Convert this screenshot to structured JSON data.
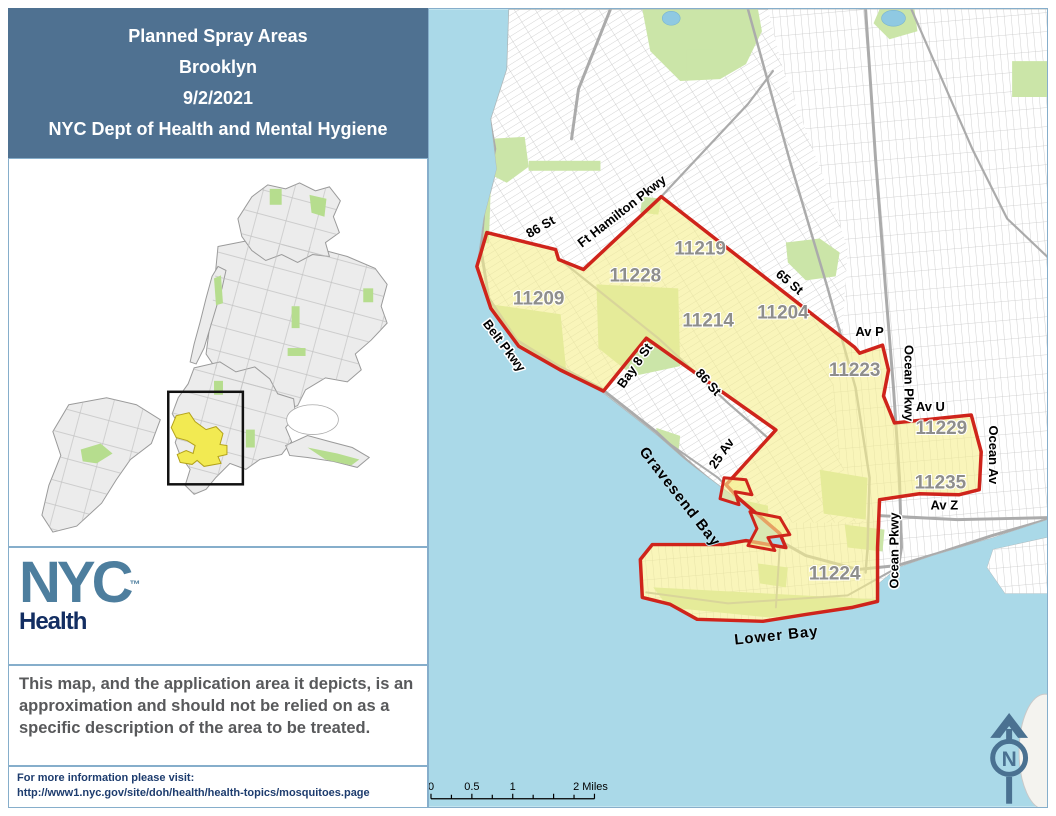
{
  "title_block": {
    "lines": [
      "Planned Spray Areas",
      "Brooklyn",
      "9/2/2021",
      "NYC Dept of Health and Mental Hygiene"
    ]
  },
  "logo": {
    "nyc": "NYC",
    "tm": "™",
    "sub": "Health"
  },
  "disclaimer": "This map, and the application area it depicts, is an approximation and should not be relied on as a specific description of the area to be treated.",
  "footer": {
    "line1": "For more information please visit:",
    "line2": "http://www1.nyc.gov/site/doh/health/health-topics/mosquitoes.page"
  },
  "map": {
    "zip_labels": [
      {
        "text": "11219",
        "x": 272,
        "y": 246
      },
      {
        "text": "11228",
        "x": 207,
        "y": 273
      },
      {
        "text": "11209",
        "x": 110,
        "y": 296
      },
      {
        "text": "11214",
        "x": 280,
        "y": 318
      },
      {
        "text": "11204",
        "x": 355,
        "y": 310
      },
      {
        "text": "11223",
        "x": 427,
        "y": 368
      },
      {
        "text": "11229",
        "x": 514,
        "y": 426
      },
      {
        "text": "11235",
        "x": 513,
        "y": 481
      },
      {
        "text": "11224",
        "x": 407,
        "y": 572
      }
    ],
    "street_labels": [
      {
        "text": "86 St",
        "x": 114,
        "y": 222,
        "rot": -30
      },
      {
        "text": "Ft Hamilton Pkwy",
        "x": 196,
        "y": 206,
        "rot": -38
      },
      {
        "text": "65 St",
        "x": 359,
        "y": 277,
        "rot": 40
      },
      {
        "text": "Belt Pkwy",
        "x": 72,
        "y": 340,
        "rot": 53
      },
      {
        "text": "Bay 8 St",
        "x": 210,
        "y": 360,
        "rot": -55
      },
      {
        "text": "86 St",
        "x": 277,
        "y": 377,
        "rot": 48
      },
      {
        "text": "25 Av",
        "x": 297,
        "y": 448,
        "rot": -55
      },
      {
        "text": "Av P",
        "x": 442,
        "y": 328,
        "rot": 0
      },
      {
        "text": "Ocean Pkwy",
        "x": 477,
        "y": 375,
        "rot": 90
      },
      {
        "text": "Av U",
        "x": 503,
        "y": 403,
        "rot": 0
      },
      {
        "text": "Ocean Av",
        "x": 562,
        "y": 447,
        "rot": 90
      },
      {
        "text": "Av Z",
        "x": 517,
        "y": 502,
        "rot": 0
      },
      {
        "text": "Ocean Pkwy",
        "x": 471,
        "y": 543,
        "rot": -90
      }
    ],
    "water_labels": [
      {
        "text": "Gravesend Bay",
        "x": 248,
        "y": 492,
        "rot": 52
      },
      {
        "text": "Lower Bay",
        "x": 349,
        "y": 633,
        "rot": -6
      }
    ],
    "scalebar": {
      "labels": [
        {
          "text": "0",
          "x": 2,
          "anchor": "middle"
        },
        {
          "text": "0.5",
          "x": 43,
          "anchor": "middle"
        },
        {
          "text": "1",
          "x": 84,
          "anchor": "middle"
        },
        {
          "text": "2 Miles",
          "x": 162,
          "anchor": "start"
        }
      ]
    },
    "north_label": "N"
  },
  "colors": {
    "title_bg": "#4f7191",
    "water": "#aad9e8",
    "spray_fill": "#f6ef8f",
    "spray_border": "#cf241b",
    "park_green": "#cbe5a8",
    "inset_yellow": "#f2ea52",
    "logo_blue": "#4d7e9e",
    "health_navy": "#132e62"
  }
}
